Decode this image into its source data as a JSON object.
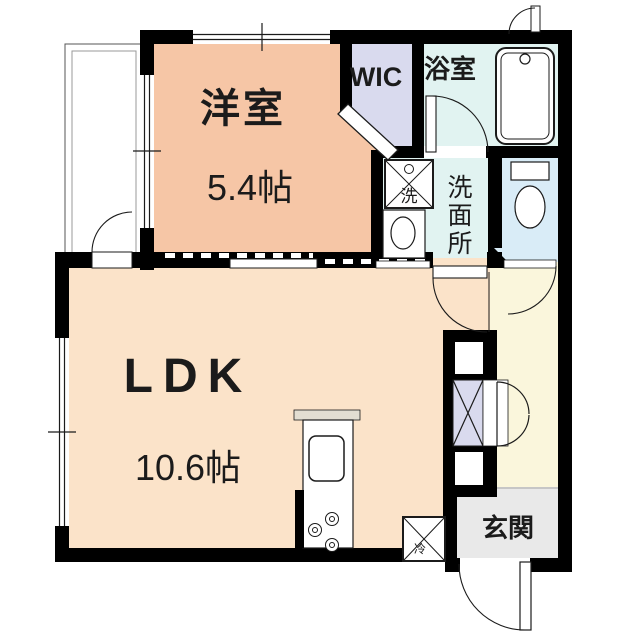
{
  "floorplan": {
    "rooms": {
      "yoshitsu": {
        "name": "洋室",
        "size": "5.4帖"
      },
      "ldk": {
        "name": "LDK",
        "size": "10.6帖"
      },
      "wic": {
        "name": "WIC"
      },
      "bathroom": {
        "name": "浴室"
      },
      "washroom": {
        "name": "洗面所",
        "chars": [
          "洗",
          "面",
          "所"
        ]
      },
      "genkan": {
        "name": "玄関"
      }
    },
    "fixtures": {
      "washer_label": "洗",
      "fridge_label": "冷"
    },
    "colors": {
      "wall": "#000000",
      "yoshitsu": "#f6c6a6",
      "ldk": "#fbe3c9",
      "wic": "#d9daee",
      "bathroom": "#e1f3f1",
      "washroom": "#e1f3f1",
      "toilet": "#d9ecf7",
      "hallway": "#faf6dc",
      "genkan": "#e9e9e9",
      "closet": "#d9daee",
      "balcony": "#ffffff",
      "fixture_fill": "#ffffff",
      "counter_cap": "#e2ded2"
    }
  }
}
